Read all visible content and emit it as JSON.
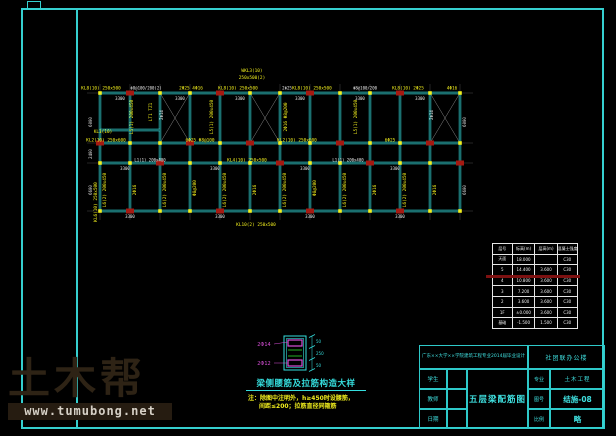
{
  "colors": {
    "cyan": "#35dede",
    "frame_cyan": "#35cfcf",
    "yellow": "#f2ef1d",
    "red": "#a51a12",
    "white": "#e8e8e8",
    "magenta": "#d94fd9",
    "green": "#27c427",
    "gray": "#6e6e6e",
    "red_strike": "#7d1111",
    "watermark_brown": "#2e2315"
  },
  "plan": {
    "x0": 100,
    "bay": 30,
    "cols": 13,
    "rows": {
      "top": 93,
      "mid": 143,
      "corr": 163,
      "bot": 211
    },
    "partial_line": {
      "x1": 100,
      "x2": 160,
      "y": 130
    },
    "red_columns": {
      "top": [
        1,
        4,
        7,
        10
      ],
      "mid": [
        0,
        3,
        5,
        8,
        11
      ],
      "corr": [
        2,
        6,
        9,
        12
      ],
      "bot": [
        1,
        4,
        7,
        10
      ]
    },
    "braces": [
      2,
      5,
      11
    ],
    "labels": [
      [
        101,
        89.5,
        0,
        "KL8(10) 250x500",
        "y"
      ],
      [
        146,
        89.5,
        0,
        "Φ8@100/200(2)",
        "w"
      ],
      [
        191,
        89.5,
        0,
        "2Φ25 4Φ16",
        "y"
      ],
      [
        238,
        89.5,
        0,
        "KL8(10) 250x500",
        "y"
      ],
      [
        287,
        89.5,
        0,
        "2Φ25",
        "w"
      ],
      [
        312,
        89.5,
        0,
        "KL8(10) 250x500",
        "y"
      ],
      [
        365,
        89.5,
        0,
        "Φ8@100/200",
        "w"
      ],
      [
        408,
        89.5,
        0,
        "KL8(10) 2Φ25",
        "y"
      ],
      [
        452,
        89.5,
        0,
        "4Φ16",
        "y"
      ],
      [
        252,
        72,
        0,
        "WKL3(10)",
        "y"
      ],
      [
        252,
        79,
        0,
        "250x500(2)",
        "y"
      ],
      [
        106,
        141.5,
        0,
        "KL2(10) 250x600",
        "y"
      ],
      [
        200,
        141.5,
        0,
        "6Φ25 Φ8@100",
        "y"
      ],
      [
        297,
        141.5,
        0,
        "KL2(10) 250x600",
        "y"
      ],
      [
        390,
        141.5,
        0,
        "6Φ25",
        "y"
      ],
      [
        150,
        161.5,
        0,
        "L1(1) 200x400",
        "w"
      ],
      [
        247,
        161.5,
        0,
        "KL4(10) 250x500",
        "y"
      ],
      [
        348,
        161.5,
        0,
        "L1(1) 200x400",
        "w"
      ],
      [
        103,
        133,
        0,
        "KL1(10)",
        "y"
      ],
      [
        133,
        117,
        -90,
        "L5(1) 200x450",
        "y"
      ],
      [
        163,
        115,
        -90,
        "2Φ14",
        "w"
      ],
      [
        152,
        112,
        -90,
        "LT1 TZ1",
        "y"
      ],
      [
        213,
        117,
        -90,
        "L5(1) 200x450",
        "y"
      ],
      [
        287,
        117,
        -90,
        "2Φ16 Φ8@200",
        "y"
      ],
      [
        357,
        117,
        -90,
        "L5(1) 200x450",
        "y"
      ],
      [
        433,
        115,
        -90,
        "2Φ14",
        "w"
      ],
      [
        106,
        190,
        -90,
        "L6(2) 200x450",
        "y"
      ],
      [
        136,
        190,
        -90,
        "2Φ16",
        "y"
      ],
      [
        166,
        190,
        -90,
        "L6(2) 200x450",
        "y"
      ],
      [
        196,
        188,
        -90,
        "Φ8@200",
        "y"
      ],
      [
        226,
        190,
        -90,
        "L6(2) 200x450",
        "y"
      ],
      [
        256,
        190,
        -90,
        "2Φ16",
        "y"
      ],
      [
        286,
        190,
        -90,
        "L6(2) 200x450",
        "y"
      ],
      [
        316,
        188,
        -90,
        "Φ8@200",
        "y"
      ],
      [
        346,
        190,
        -90,
        "L6(2) 200x450",
        "y"
      ],
      [
        376,
        190,
        -90,
        "2Φ16",
        "y"
      ],
      [
        406,
        190,
        -90,
        "L6(2) 200x450",
        "y"
      ],
      [
        436,
        190,
        -90,
        "2Φ16",
        "y"
      ],
      [
        120,
        100,
        0,
        "3300",
        "w"
      ],
      [
        180,
        100,
        0,
        "3300",
        "w"
      ],
      [
        240,
        100,
        0,
        "3300",
        "w"
      ],
      [
        300,
        100,
        0,
        "3300",
        "w"
      ],
      [
        360,
        100,
        0,
        "3300",
        "w"
      ],
      [
        420,
        100,
        0,
        "3300",
        "w"
      ],
      [
        125,
        170,
        0,
        "3300",
        "w"
      ],
      [
        215,
        170,
        0,
        "3300",
        "w"
      ],
      [
        305,
        170,
        0,
        "3300",
        "w"
      ],
      [
        395,
        170,
        0,
        "3300",
        "w"
      ],
      [
        92,
        122,
        -90,
        "6000",
        "w"
      ],
      [
        92,
        154,
        -90,
        "2400",
        "w"
      ],
      [
        92,
        190,
        -90,
        "6600",
        "w"
      ],
      [
        97,
        202,
        -90,
        "KL6(10) 250x500",
        "y"
      ],
      [
        466,
        122,
        -90,
        "6000",
        "w"
      ],
      [
        466,
        190,
        -90,
        "6600",
        "w"
      ],
      [
        256,
        226,
        0,
        "KL10(2) 250x500",
        "y"
      ],
      [
        130,
        218,
        0,
        "3300",
        "w"
      ],
      [
        220,
        218,
        0,
        "3300",
        "w"
      ],
      [
        310,
        218,
        0,
        "3300",
        "w"
      ],
      [
        400,
        218,
        0,
        "3300",
        "w"
      ]
    ]
  },
  "detail": {
    "title": "梁侧腰筋及拉筋构造大样",
    "note1": "注：除图中注明外，h≥450时设腰筋，",
    "note2": "间距≤200；拉筋直径同箍筋",
    "rebar_top": "2Φ14",
    "rebar_bottom": "2Φ12",
    "dims": [
      "50",
      "250",
      "50"
    ]
  },
  "floor_table": {
    "headers": [
      "层号",
      "标高(m)",
      "层高(m)",
      "混凝土强度"
    ],
    "rows": [
      [
        "天面",
        "18.000",
        "",
        "C30"
      ],
      [
        "5",
        "14.400",
        "3.600",
        "C30"
      ],
      [
        "4",
        "10.800",
        "3.600",
        "C30"
      ],
      [
        "3",
        "7.200",
        "3.600",
        "C30"
      ],
      [
        "2",
        "3.600",
        "3.600",
        "C30"
      ],
      [
        "1F",
        "±0.000",
        "3.600",
        "C30"
      ],
      [
        "基础",
        "-1.500",
        "1.500",
        "C30"
      ]
    ]
  },
  "title_block": {
    "project": "广东××大学××学院建筑工程专业2014届毕业设计",
    "building": "社团联办公楼",
    "student_label": "学生",
    "teacher_label": "教师",
    "date_label": "日期",
    "drawing_title": "五层梁配筋图",
    "major_label": "专业",
    "major_value": "土木工程",
    "sheet_label": "图号",
    "sheet_value": "结施-08",
    "scale_label": "比例",
    "scale_value": "略"
  },
  "watermark": {
    "brand": "土木帮",
    "url": "www.tumubong.net"
  }
}
